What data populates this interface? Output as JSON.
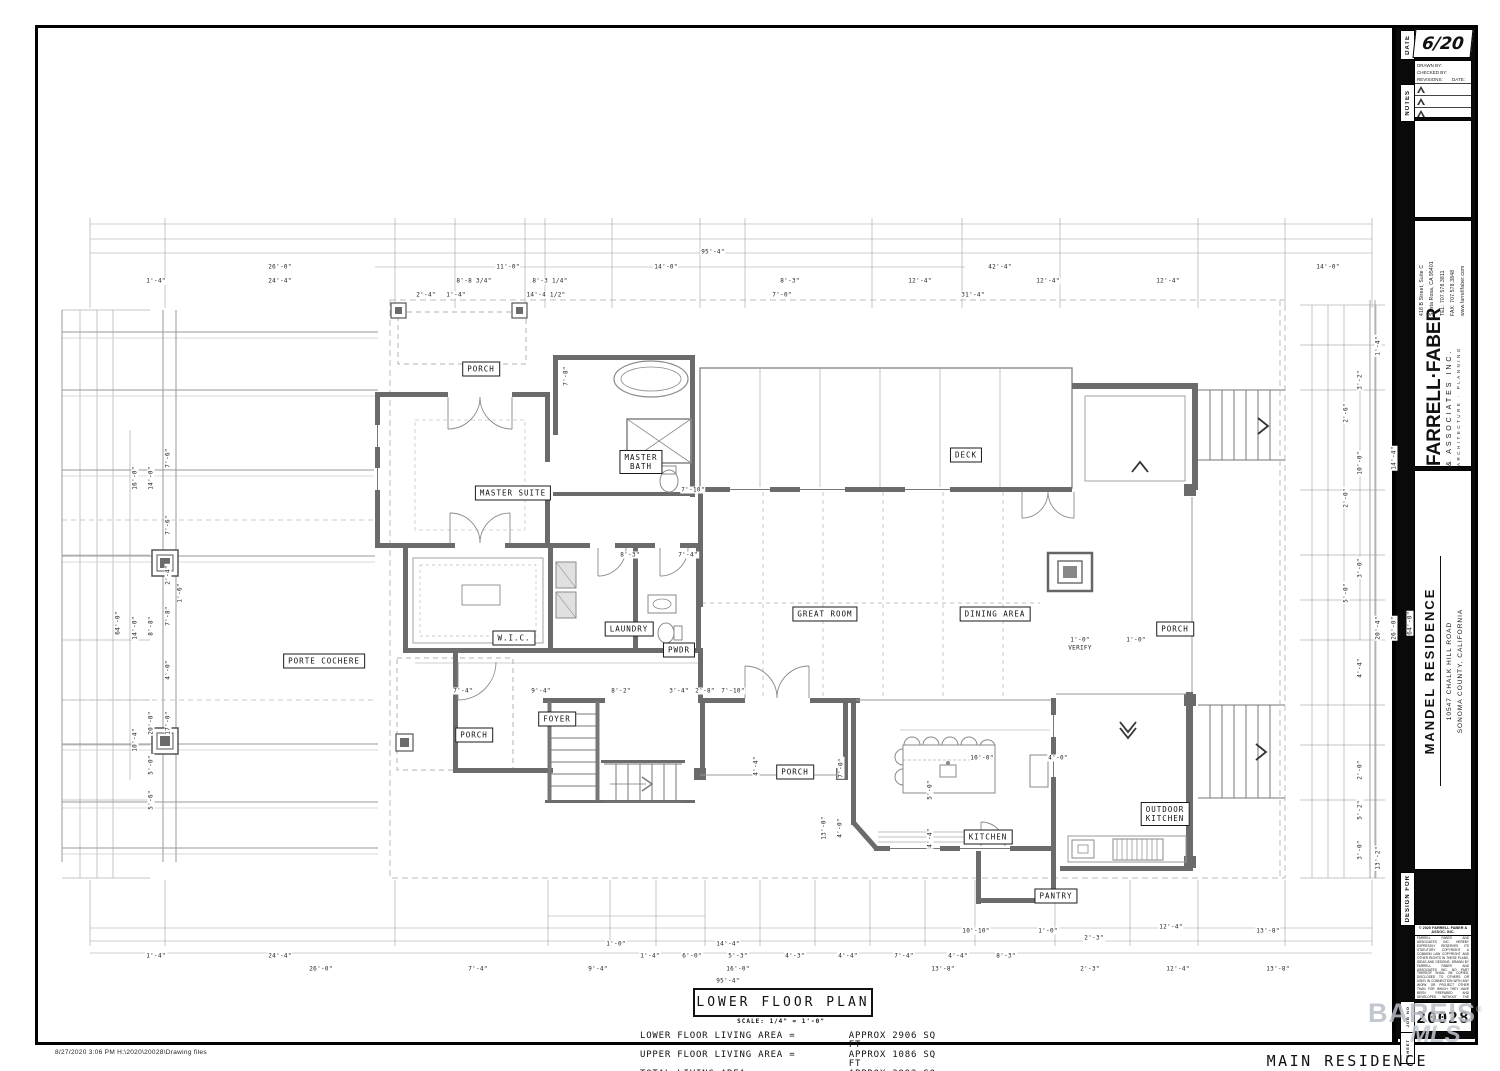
{
  "titleblock": {
    "date_tab": "DATE",
    "date_value": "6/20",
    "notes_tab": "NOTES",
    "drawn_by": "DRAWN BY:",
    "checked_by": "CHECKED BY:",
    "revisions": "REVISIONS:",
    "rev_date": "DATE:",
    "firm": {
      "name": "FARRELL·FABER",
      "assoc": "& ASSOCIATES INC.",
      "tagline": "ARCHITECTURE · PLANNING",
      "addr1": "418 B Street, Suite C",
      "addr2": "Santa Rosa, CA 95401",
      "tel": "TEL: 707.578.3811",
      "fax": "FAX: 707.578.3848",
      "web": "www.farrellfaber.com"
    },
    "project": {
      "name": "MANDEL RESIDENCE",
      "addr1": "10547 CHALK HILL ROAD",
      "addr2": "SONOMA COUNTY, CALIFORNIA"
    },
    "design_for_tab": "DESIGN FOR",
    "copyright": {
      "header": "© 2020 FARRELL FABER & ASSOC. INC.",
      "body": "FARRELL FABER AND ASSOCIATES INC. HEREBY EXPRESSLY RESERVES ITS STATUTORY COPYRIGHT & COMMON LAW COPYRIGHT AND OTHER RIGHTS IN THESE PLANS, IDEAS AND DESIGNS. DRAWN BY FARRELL FABER AND ASSOCIATES INC. NO PART THEREOF SHALL BE COPIED, DISCLOSED TO OTHERS OR USED IN CONNECTION WITH ANY WORK OR PROJECT OTHER THAN FOR WHICH THEY HAVE BEEN PREPARED AND DEVELOPED WITHOUT THE WRITTEN CONSENT OF FARRELL FABER AND ASSOCIATES INC. VISUAL CONTACT WITH THESE PLANS SHALL CONSTITUTE CONCLUSIVE EVIDENCE OF ACCEPTANCE OF THESE RESTRICTIONS.",
      "f1": "DO",
      "f2": "NOT",
      "f3": "SCALE",
      "f4": "PLANS"
    },
    "job_tab": "JOB NO",
    "job_value": "20028",
    "sheet_tab": "SHEET",
    "watermark_line1": "BAREIS",
    "watermark_reg": "®",
    "watermark_line2": "MLS",
    "colors": {
      "watermark": "#b7bdc7",
      "wall": "#6b6b6b"
    }
  },
  "plan": {
    "title": "LOWER FLOOR PLAN",
    "scale_note": "SCALE: 1/4\" = 1'-0\"",
    "main_label": "MAIN RESIDENCE",
    "footer_path": "8/27/2020    3:06 PM    H:\\2020\\20028\\Drawing files",
    "areas": [
      {
        "label": "LOWER FLOOR LIVING AREA =",
        "value": "APPROX 2906 SQ FT",
        "gap": false
      },
      {
        "label": "UPPER FLOOR LIVING AREA =",
        "value": "APPROX 1086 SQ FT",
        "gap": false
      },
      {
        "label": "TOTAL LIVING AREA -",
        "value": "APPROX 3992 SQ FT",
        "gap": false
      },
      {
        "label": "OUTDOOR COVERED AREA =",
        "value": "APPROX 561 SQ FT",
        "gap": true
      }
    ],
    "rooms": [
      {
        "label": "PORCH",
        "x": 443,
        "y": 341
      },
      {
        "label": "MASTER SUITE",
        "x": 475,
        "y": 465
      },
      {
        "label": "MASTER",
        "l2": "BATH",
        "x": 603,
        "y": 434
      },
      {
        "label": "DECK",
        "x": 928,
        "y": 427
      },
      {
        "label": "GREAT ROOM",
        "x": 787,
        "y": 586
      },
      {
        "label": "DINING AREA",
        "x": 957,
        "y": 586
      },
      {
        "label": "PORCH",
        "x": 1137,
        "y": 601
      },
      {
        "label": "PORTE COCHERE",
        "x": 286,
        "y": 633
      },
      {
        "label": "W.I.C.",
        "x": 476,
        "y": 610
      },
      {
        "label": "LAUNDRY",
        "x": 591,
        "y": 601
      },
      {
        "label": "PWDR",
        "x": 641,
        "y": 622
      },
      {
        "label": "FOYER",
        "x": 519,
        "y": 691
      },
      {
        "label": "PORCH",
        "x": 436,
        "y": 707
      },
      {
        "label": "PORCH",
        "x": 757,
        "y": 744
      },
      {
        "label": "KITCHEN",
        "x": 950,
        "y": 809
      },
      {
        "label": "OUTDOOR",
        "l2": "KITCHEN",
        "x": 1127,
        "y": 786
      },
      {
        "label": "PANTRY",
        "x": 1018,
        "y": 868
      }
    ],
    "dimensions": [
      {
        "t": "95'-4\"",
        "x": 675,
        "y": 224
      },
      {
        "t": "26'-0\"",
        "x": 242,
        "y": 239
      },
      {
        "t": "11'-0\"",
        "x": 470,
        "y": 239
      },
      {
        "t": "14'-0\"",
        "x": 628,
        "y": 239
      },
      {
        "t": "42'-4\"",
        "x": 962,
        "y": 239
      },
      {
        "t": "14'-0\"",
        "x": 1290,
        "y": 239
      },
      {
        "t": "1'-4\"",
        "x": 118,
        "y": 253
      },
      {
        "t": "24'-4\"",
        "x": 242,
        "y": 253
      },
      {
        "t": "8'-8 3/4\"",
        "x": 436,
        "y": 253
      },
      {
        "t": "8'-3 1/4\"",
        "x": 512,
        "y": 253
      },
      {
        "t": "8'-3\"",
        "x": 752,
        "y": 253
      },
      {
        "t": "12'-4\"",
        "x": 882,
        "y": 253
      },
      {
        "t": "12'-4\"",
        "x": 1010,
        "y": 253
      },
      {
        "t": "12'-4\"",
        "x": 1130,
        "y": 253
      },
      {
        "t": "2'-4\"",
        "x": 388,
        "y": 267
      },
      {
        "t": "1'-4\"",
        "x": 418,
        "y": 267
      },
      {
        "t": "14'-4 1/2\"",
        "x": 508,
        "y": 267
      },
      {
        "t": "7'-0\"",
        "x": 744,
        "y": 267
      },
      {
        "t": "31'-4\"",
        "x": 935,
        "y": 267
      },
      {
        "t": "7'-8\"",
        "x": 528,
        "y": 348,
        "rot": true
      },
      {
        "t": "7'-10\"",
        "x": 655,
        "y": 462
      },
      {
        "t": "8'-3\"",
        "x": 592,
        "y": 527
      },
      {
        "t": "7'-4\"",
        "x": 650,
        "y": 527
      },
      {
        "t": "7'-4\"",
        "x": 425,
        "y": 663
      },
      {
        "t": "9'-4\"",
        "x": 503,
        "y": 663
      },
      {
        "t": "8'-2\"",
        "x": 583,
        "y": 663
      },
      {
        "t": "3'-4\"",
        "x": 641,
        "y": 663
      },
      {
        "t": "2'-8\"",
        "x": 667,
        "y": 663
      },
      {
        "t": "7'-10\"",
        "x": 695,
        "y": 663
      },
      {
        "t": "1'-0\"",
        "x": 1042,
        "y": 612
      },
      {
        "t": "VERIFY",
        "x": 1042,
        "y": 620
      },
      {
        "t": "1'-0\"",
        "x": 1098,
        "y": 612
      },
      {
        "t": "10'-0\"",
        "x": 944,
        "y": 730
      },
      {
        "t": "4'-0\"",
        "x": 1020,
        "y": 730
      },
      {
        "t": "5'-0\"",
        "x": 892,
        "y": 762,
        "rot": true
      },
      {
        "t": "4'-4\"",
        "x": 892,
        "y": 810,
        "rot": true
      },
      {
        "t": "7'-0\"",
        "x": 803,
        "y": 740,
        "rot": true
      },
      {
        "t": "4'-4\"",
        "x": 718,
        "y": 738,
        "rot": true
      },
      {
        "t": "13'-0\"",
        "x": 786,
        "y": 800,
        "rot": true
      },
      {
        "t": "4'-0\"",
        "x": 802,
        "y": 800,
        "rot": true
      },
      {
        "t": "64'-0\"",
        "x": 80,
        "y": 595,
        "rot": true
      },
      {
        "t": "16'-0\"",
        "x": 97,
        "y": 450,
        "rot": true
      },
      {
        "t": "14'-0\"",
        "x": 113,
        "y": 450,
        "rot": true
      },
      {
        "t": "7'-6\"",
        "x": 130,
        "y": 430,
        "rot": true
      },
      {
        "t": "7'-6\"",
        "x": 130,
        "y": 497,
        "rot": true
      },
      {
        "t": "2'-4\"",
        "x": 130,
        "y": 547,
        "rot": true
      },
      {
        "t": "14'-0\"",
        "x": 97,
        "y": 600,
        "rot": true
      },
      {
        "t": "8'-8\"",
        "x": 113,
        "y": 598,
        "rot": true
      },
      {
        "t": "7'-8\"",
        "x": 130,
        "y": 588,
        "rot": true
      },
      {
        "t": "1'-6\"",
        "x": 142,
        "y": 565,
        "rot": true
      },
      {
        "t": "4'-0\"",
        "x": 130,
        "y": 642,
        "rot": true
      },
      {
        "t": "20'-0\"",
        "x": 113,
        "y": 695,
        "rot": true
      },
      {
        "t": "17'-0\"",
        "x": 130,
        "y": 695,
        "rot": true
      },
      {
        "t": "10'-4\"",
        "x": 97,
        "y": 712,
        "rot": true
      },
      {
        "t": "5'-0\"",
        "x": 113,
        "y": 737,
        "rot": true
      },
      {
        "t": "5'-6\"",
        "x": 113,
        "y": 772,
        "rot": true
      },
      {
        "t": "1'-4\"",
        "x": 1340,
        "y": 318,
        "rot": true
      },
      {
        "t": "3'-2\"",
        "x": 1322,
        "y": 352,
        "rot": true
      },
      {
        "t": "2'-6\"",
        "x": 1308,
        "y": 385,
        "rot": true
      },
      {
        "t": "10'-0\"",
        "x": 1322,
        "y": 435,
        "rot": true
      },
      {
        "t": "14'-4\"",
        "x": 1356,
        "y": 430,
        "rot": true
      },
      {
        "t": "2'-0\"",
        "x": 1308,
        "y": 470,
        "rot": true
      },
      {
        "t": "3'-0\"",
        "x": 1322,
        "y": 540,
        "rot": true
      },
      {
        "t": "5'-0\"",
        "x": 1308,
        "y": 565,
        "rot": true
      },
      {
        "t": "20'-4\"",
        "x": 1340,
        "y": 600,
        "rot": true
      },
      {
        "t": "26'-0\"",
        "x": 1356,
        "y": 600,
        "rot": true
      },
      {
        "t": "64'-0\"",
        "x": 1372,
        "y": 595,
        "rot": true
      },
      {
        "t": "4'-4\"",
        "x": 1322,
        "y": 640,
        "rot": true
      },
      {
        "t": "2'-0\"",
        "x": 1322,
        "y": 742,
        "rot": true
      },
      {
        "t": "5'-2\"",
        "x": 1322,
        "y": 782,
        "rot": true
      },
      {
        "t": "3'-0\"",
        "x": 1322,
        "y": 822,
        "rot": true
      },
      {
        "t": "13'-2\"",
        "x": 1340,
        "y": 830,
        "rot": true
      },
      {
        "t": "1'-0\"",
        "x": 578,
        "y": 916
      },
      {
        "t": "14'-4\"",
        "x": 690,
        "y": 916
      },
      {
        "t": "10'-10\"",
        "x": 938,
        "y": 903
      },
      {
        "t": "1'-0\"",
        "x": 1010,
        "y": 903
      },
      {
        "t": "2'-3\"",
        "x": 1056,
        "y": 910
      },
      {
        "t": "12'-4\"",
        "x": 1133,
        "y": 899
      },
      {
        "t": "13'-8\"",
        "x": 1230,
        "y": 903
      },
      {
        "t": "1'-4\"",
        "x": 118,
        "y": 928
      },
      {
        "t": "24'-4\"",
        "x": 242,
        "y": 928
      },
      {
        "t": "1'-4\"",
        "x": 612,
        "y": 928
      },
      {
        "t": "6'-0\"",
        "x": 654,
        "y": 928
      },
      {
        "t": "5'-3\"",
        "x": 700,
        "y": 928
      },
      {
        "t": "4'-3\"",
        "x": 757,
        "y": 928
      },
      {
        "t": "4'-4\"",
        "x": 810,
        "y": 928
      },
      {
        "t": "7'-4\"",
        "x": 866,
        "y": 928
      },
      {
        "t": "4'-4\"",
        "x": 920,
        "y": 928
      },
      {
        "t": "8'-3\"",
        "x": 968,
        "y": 928
      },
      {
        "t": "26'-0\"",
        "x": 283,
        "y": 941
      },
      {
        "t": "7'-4\"",
        "x": 440,
        "y": 941
      },
      {
        "t": "9'-4\"",
        "x": 560,
        "y": 941
      },
      {
        "t": "16'-0\"",
        "x": 700,
        "y": 941
      },
      {
        "t": "13'-8\"",
        "x": 905,
        "y": 941
      },
      {
        "t": "2'-3\"",
        "x": 1052,
        "y": 941
      },
      {
        "t": "12'-4\"",
        "x": 1140,
        "y": 941
      },
      {
        "t": "13'-8\"",
        "x": 1240,
        "y": 941
      },
      {
        "t": "95'-4\"",
        "x": 690,
        "y": 953
      }
    ]
  }
}
